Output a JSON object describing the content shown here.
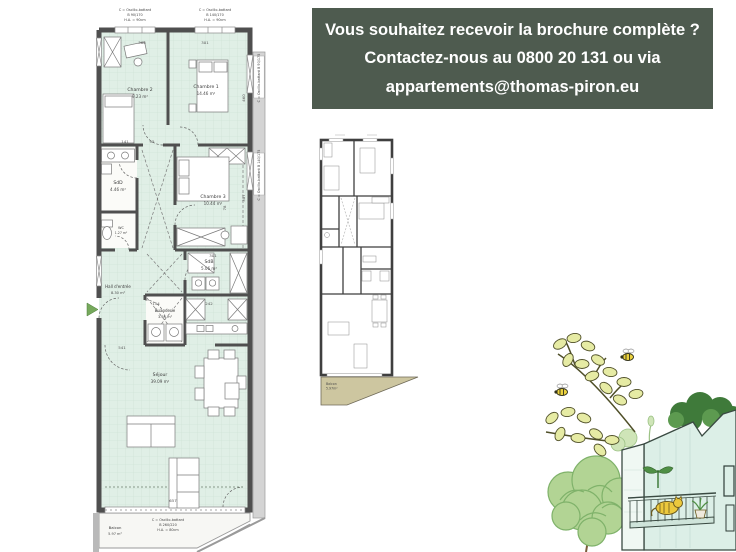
{
  "banner": {
    "lines": [
      "Vous souhaitez recevoir la brochure complète ?",
      "Contactez-nous au 0800 20 131 ou via",
      "appartements@thomas-piron.eu"
    ],
    "bg_color": "#4e5b4f",
    "text_color": "#ffffff"
  },
  "main_plan": {
    "rooms": {
      "chambre2": {
        "name": "Chambre 2",
        "area": "9.23 m²"
      },
      "chambre1": {
        "name": "Chambre 1",
        "area": "14.46 m²"
      },
      "sdd": {
        "name": "SdD",
        "area": "4.46 m²"
      },
      "chambre3": {
        "name": "Chambre 3",
        "area": "10.44 m²"
      },
      "wc": {
        "name": "WC",
        "area": "1.27 m²"
      },
      "hall": {
        "name": "Hall d'entrée",
        "area": "8.30 m²"
      },
      "buanderie": {
        "name": "Buanderie",
        "area": "3.64 m²"
      },
      "sdb": {
        "name": "SdB",
        "area": "5.06 m²"
      },
      "sejour": {
        "name": "Séjour",
        "area": "39.09 m²"
      },
      "balcon": {
        "name": "Balcon",
        "area": "5.97 m²"
      }
    },
    "annotations": {
      "top_left": [
        "C = Oscillo-battant",
        "B 90/170",
        "H.A. = 90cm"
      ],
      "top_right": [
        "C = Oscillo-battant",
        "B 140/170",
        "H.A. = 90cm"
      ],
      "bottom": [
        "C = Oscillo-battant",
        "B 260/220",
        "H.A. = 80cm"
      ],
      "right_upper": "C = Oscillo-battant  B 90/175",
      "right_lower": "C = Oscillo-battant  B 140/175"
    },
    "dimensions": {
      "d366": "366",
      "d301a": "301",
      "d141": "141",
      "d95": "95",
      "d301b": "301",
      "d154": "154",
      "d242": "242",
      "d541": "541",
      "d657": "657",
      "d460": "460",
      "d307": "307",
      "d78": "78"
    },
    "floor_color": "#e0efe6",
    "wall_color": "#4f4f4f"
  },
  "small_plan": {
    "balcon_name": "Balcon",
    "balcon_area": "5.97m²",
    "balcony_color": "#cdc6a0"
  },
  "illustration": {
    "leaf_color": "#e6eba4",
    "tree_color": "#b2d494",
    "building_color": "#dcefe7",
    "bush_color": "#3f7a3a",
    "bee_color": "#ecd23f"
  }
}
